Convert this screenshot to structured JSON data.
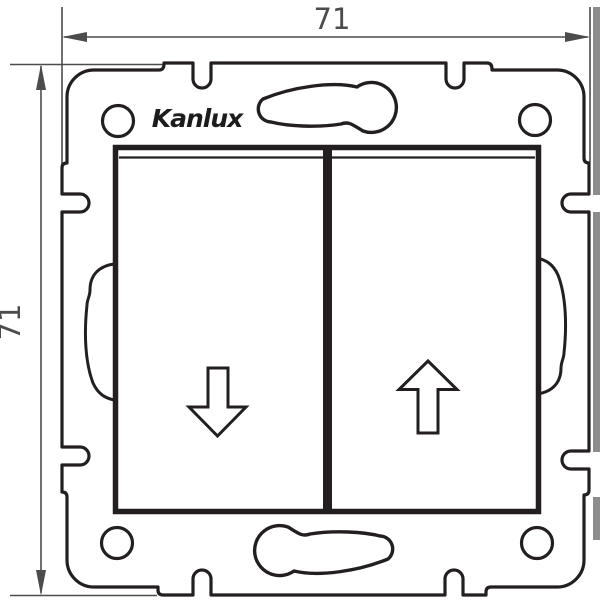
{
  "brand": {
    "logo_text": "Kanlux"
  },
  "dimensions": {
    "width_label": "71",
    "height_label": "71"
  },
  "icons": {
    "left_button": "arrow-down-icon",
    "right_button": "arrow-up-icon"
  },
  "colors": {
    "outline": "#231f20",
    "dimension_line": "#4c4c4c",
    "background": "#ffffff",
    "right_edge_artifact": "#8d8d8d"
  }
}
